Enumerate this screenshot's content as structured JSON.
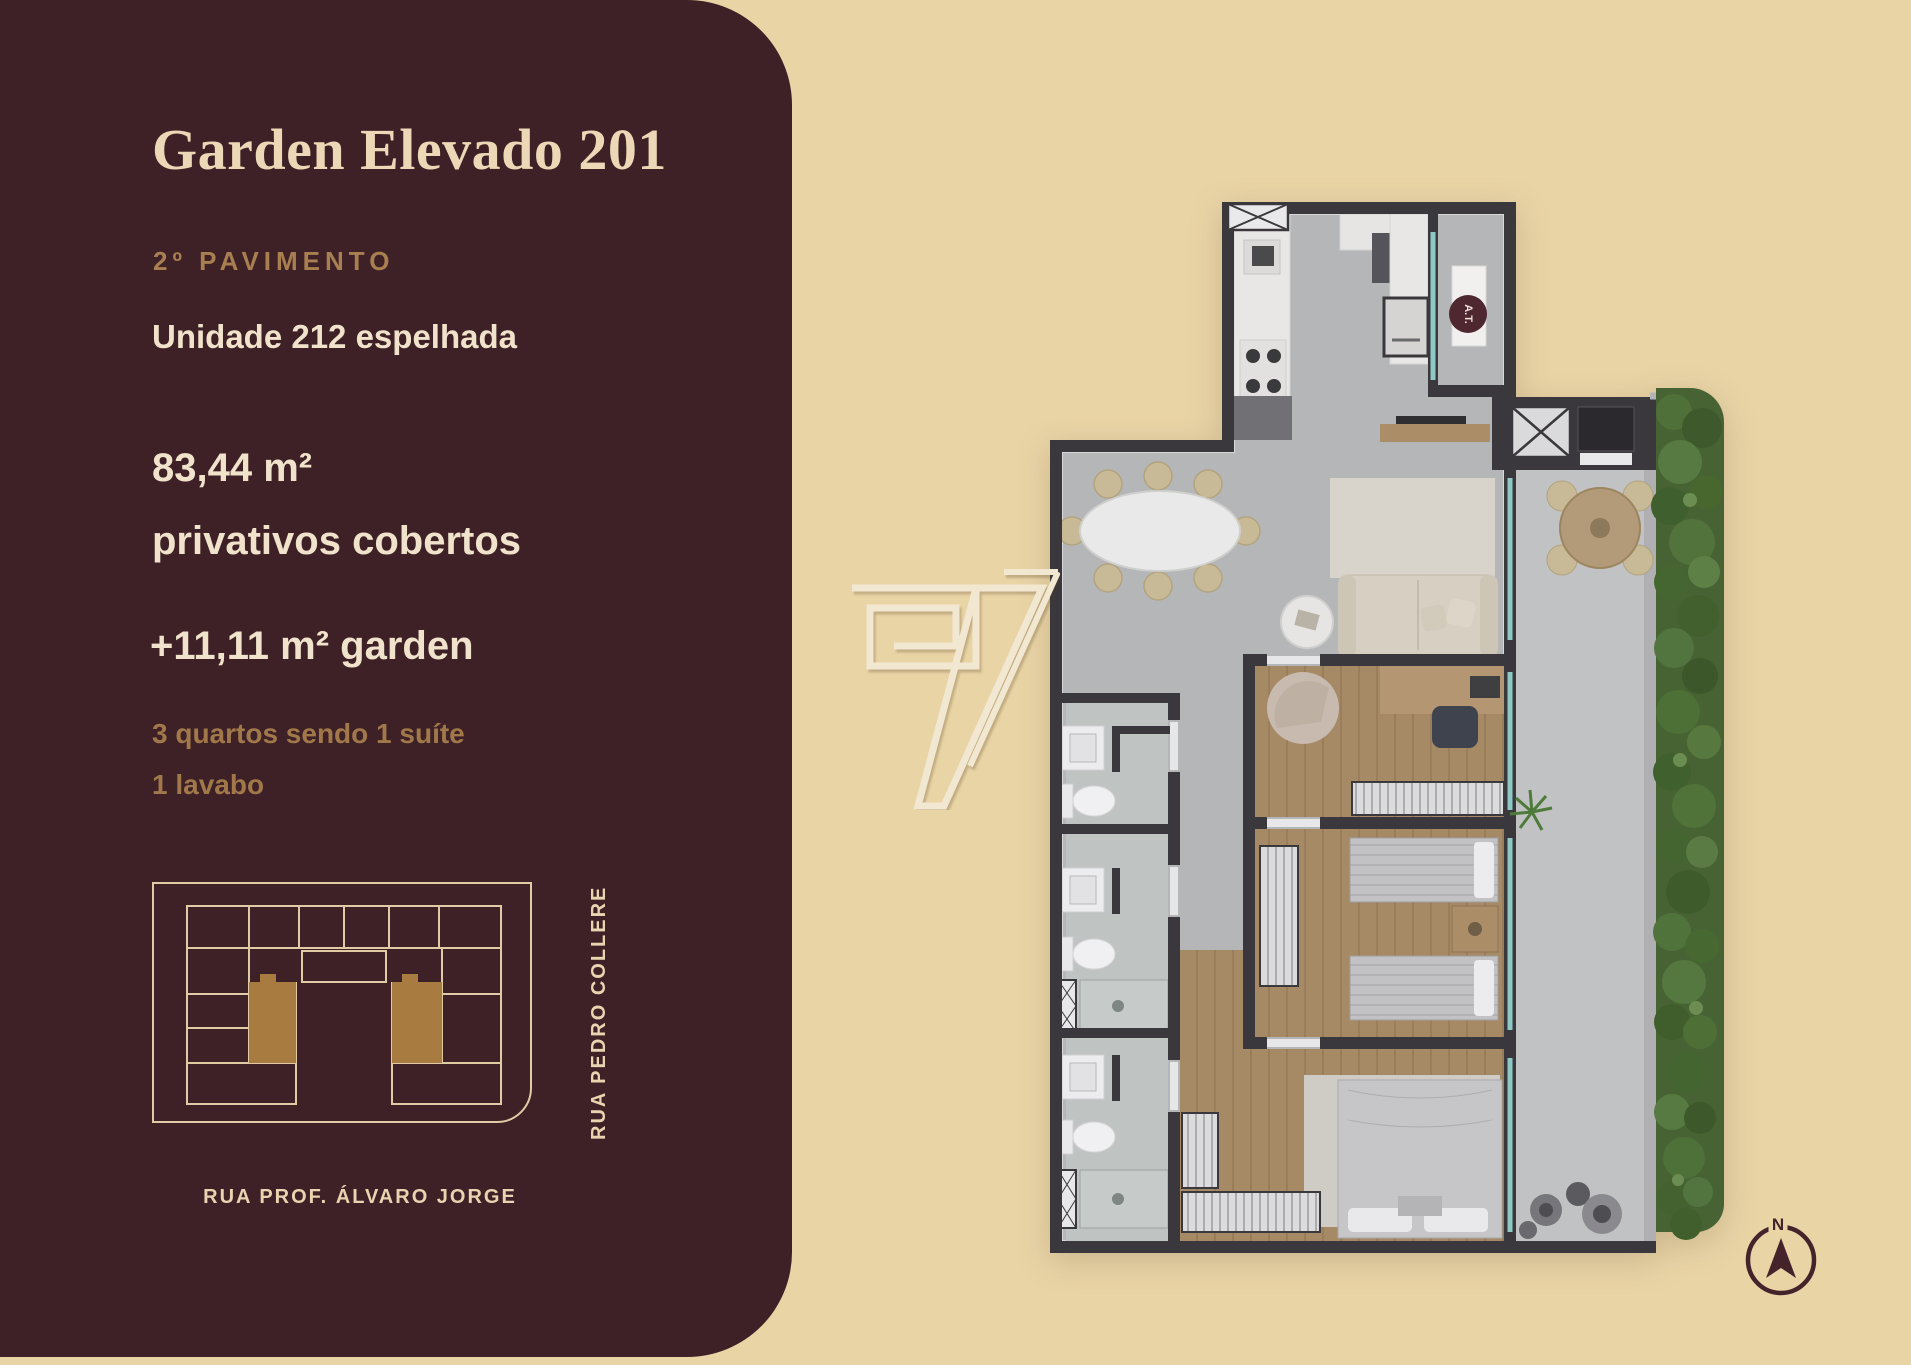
{
  "panel": {
    "title": "Garden Elevado 201",
    "floor": "2º PAVIMENTO",
    "unit": "Unidade 212 espelhada",
    "area_private_value": "83,44 m²",
    "area_private_caption": "privativos cobertos",
    "area_garden": "+11,11 m² garden",
    "features_line1": "3 quartos sendo 1 suíte",
    "features_line2": "1 lavabo",
    "site_map": {
      "street_bottom": "RUA PROF. ÁLVARO JORGE",
      "street_right": "RUA PEDRO COLLERE"
    }
  },
  "floor_plan": {
    "labels": {
      "technical_area": "A.T."
    },
    "compass_north": "N"
  },
  "colors": {
    "background_beige": "#e9d4a6",
    "panel_brown": "#3e2126",
    "cream_text": "#f0e2cb",
    "gold_accent": "#a87f50",
    "diagram_gold_fill": "#a87c41",
    "wall_dark": "#3a383c",
    "floor_gray": "#b5b6b8",
    "wood_floor": "#a68a66",
    "hedge_green": "#476334",
    "maroon_icon": "#45232b"
  }
}
